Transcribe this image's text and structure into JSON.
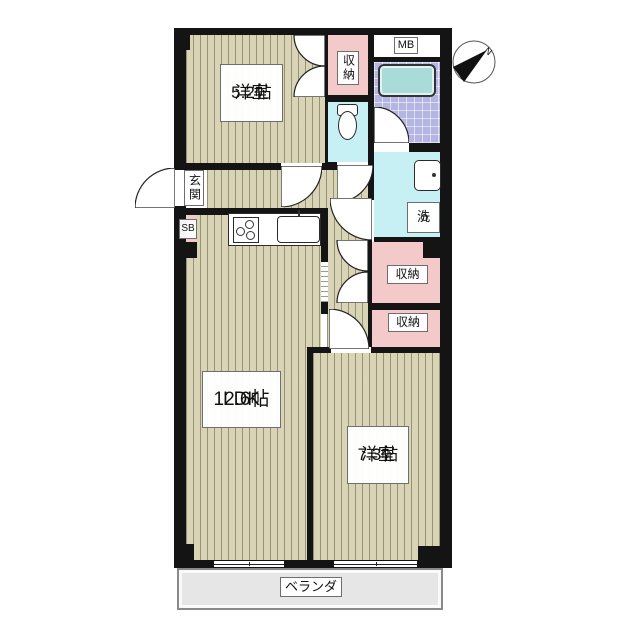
{
  "floorplan": {
    "labels": {
      "bedroom1_name": "洋室",
      "bedroom1_size": "5.2帖",
      "ldk_name": "LDK",
      "ldk_size": "12.6帖",
      "bedroom2_name": "洋室",
      "bedroom2_size": "7.3帖",
      "closet_top": "収納",
      "closet_mid": "収納",
      "closet_low": "収納",
      "entrance": "玄関",
      "shoe_box": "SB",
      "meter_box": "MB",
      "laundry": "洗",
      "veranda": "ベランダ",
      "compass_north": "N"
    },
    "colors": {
      "wall": "#141414",
      "wood_floor": "#d9d4b6",
      "closet_pink": "#f3c9c9",
      "wet_area_cyan": "#c7f0f5",
      "bath_tile": "#b5b5e2",
      "bathtub": "#a9dbd9",
      "veranda_gray": "#e6e6e6"
    }
  }
}
